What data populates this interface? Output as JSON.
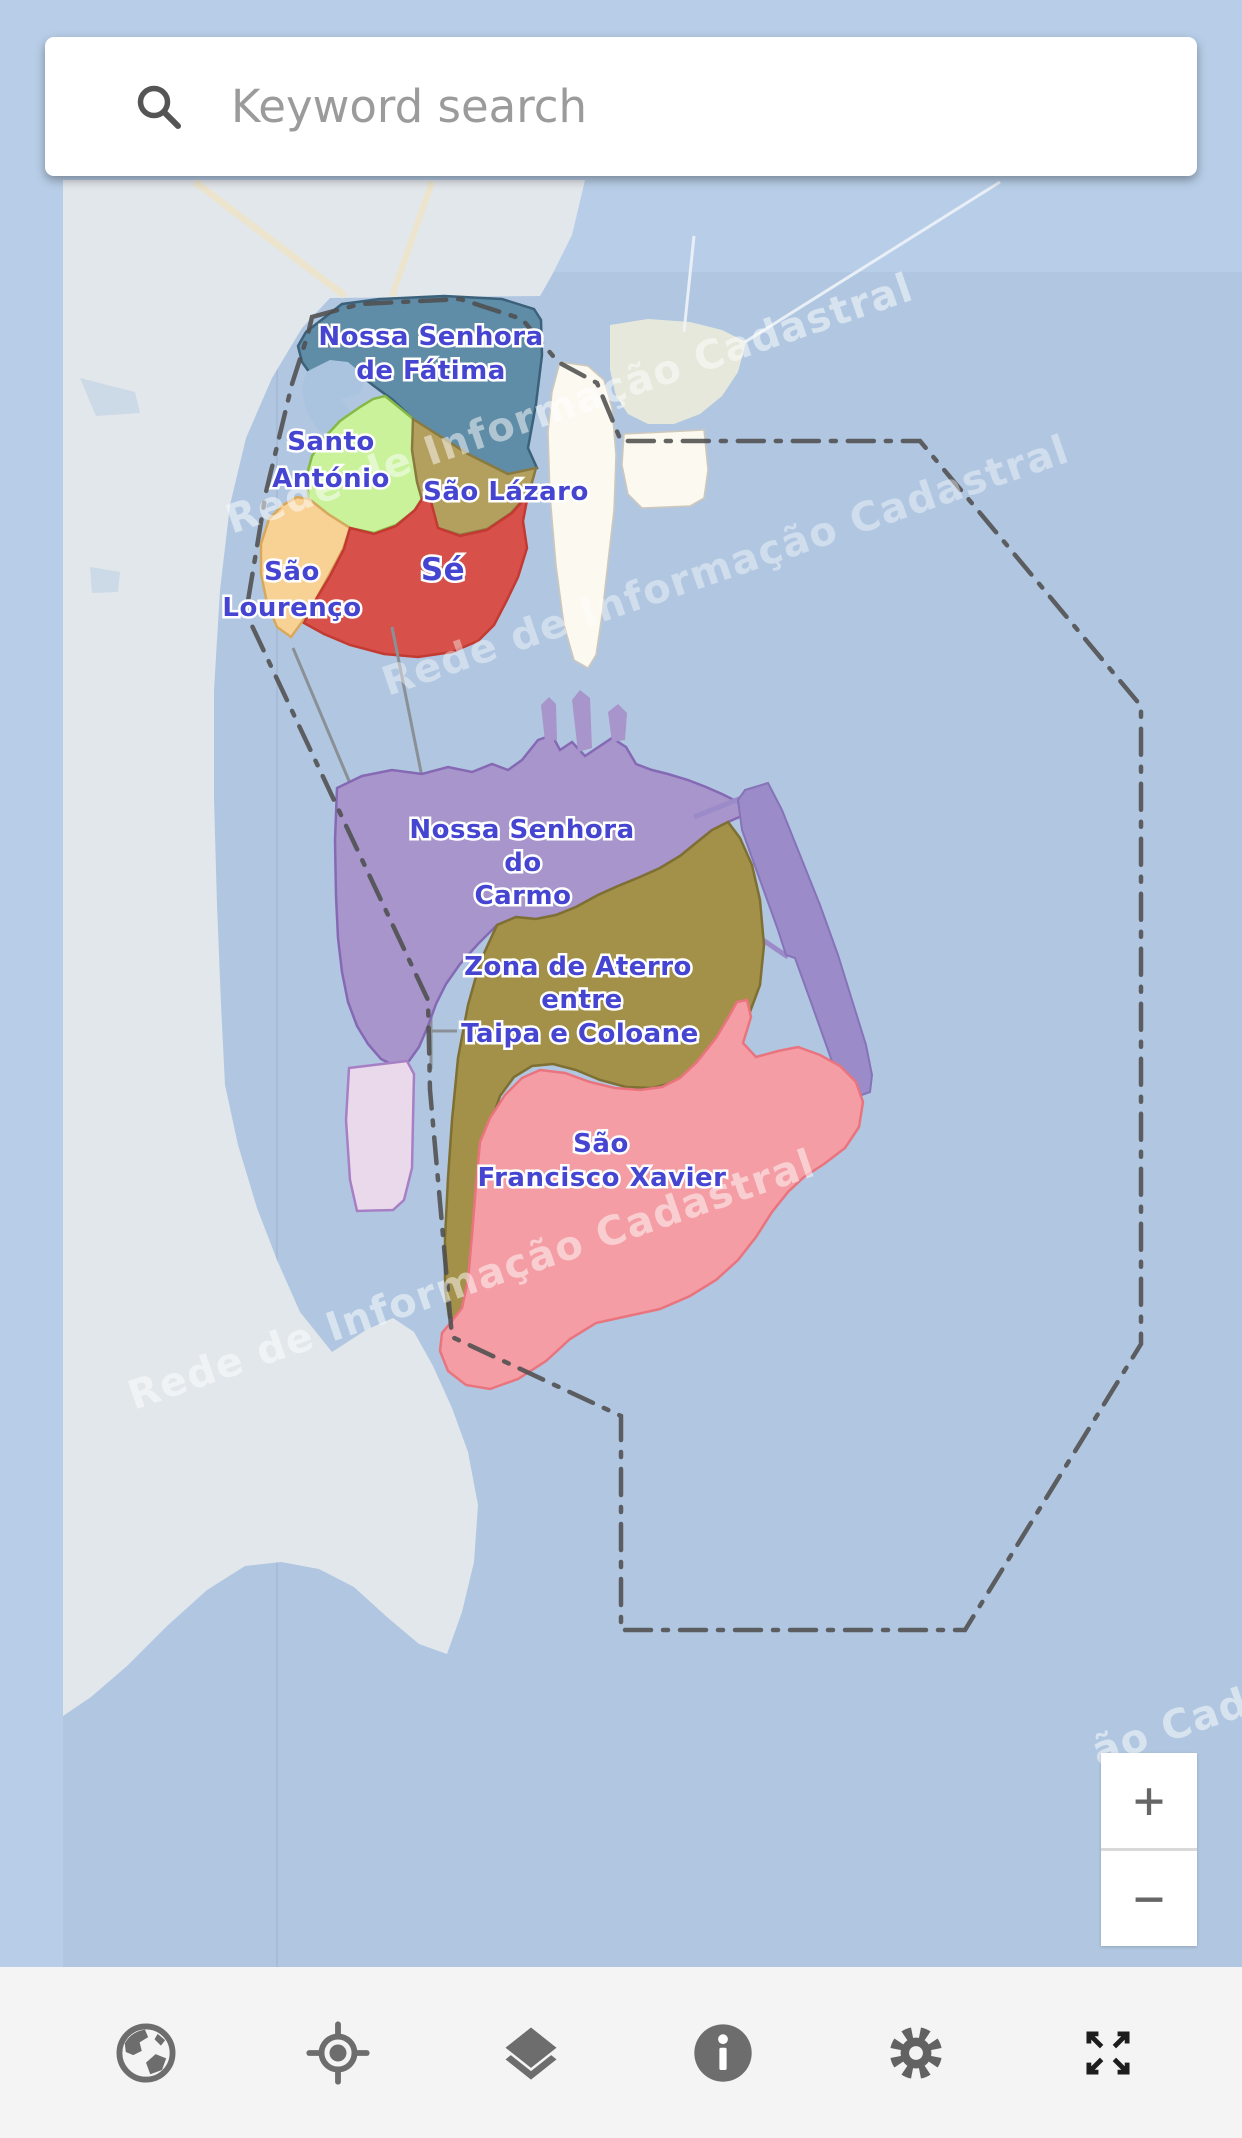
{
  "search": {
    "placeholder": "Keyword search",
    "icon": "search-icon"
  },
  "map": {
    "watermark": "Rede de Informação Cadastral",
    "watermark_fragment": "ão Cad",
    "colors": {
      "water": "#b1c7e1",
      "water_outside_tile": "#b8cee8",
      "mainland": "#e2e7eb",
      "reclaimed_white": "#fcf9f1",
      "reclaimed_pale": "#e6e8dc",
      "runway": "#9c8bc9",
      "university_parcel": "#ead9ea",
      "boundary_line": "#4f4f4f",
      "label_text": "#4545d2"
    },
    "regions": [
      {
        "id": "nossa-senhora-de-fatima",
        "label_lines": [
          "Nossa Senhora",
          "de Fátima"
        ],
        "color": "#5f8ca6"
      },
      {
        "id": "santo-antonio",
        "label_lines": [
          "Santo",
          "António"
        ],
        "color": "#c9f29b"
      },
      {
        "id": "sao-lazaro",
        "label_lines": [
          "São Lázaro"
        ],
        "color": "#b3a05e"
      },
      {
        "id": "sao-lourenco",
        "label_lines": [
          "São",
          "Lourenço"
        ],
        "color": "#f8d195"
      },
      {
        "id": "se",
        "label_lines": [
          "Sé"
        ],
        "color": "#d7514a"
      },
      {
        "id": "nossa-senhora-do-carmo",
        "label_lines": [
          "Nossa Senhora",
          "do",
          "Carmo"
        ],
        "color": "#a795cb"
      },
      {
        "id": "zona-de-aterro",
        "label_lines": [
          "Zona de Aterro",
          "entre",
          "Taipa e Coloane"
        ],
        "color": "#a39049"
      },
      {
        "id": "sao-francisco-xavier",
        "label_lines": [
          "São",
          "Francisco Xavier"
        ],
        "color": "#f49da4"
      }
    ],
    "zoom_controls": {
      "zoom_in": "+",
      "zoom_out": "−"
    }
  },
  "toolbar": {
    "buttons": [
      {
        "icon": "globe-icon"
      },
      {
        "icon": "locate-icon"
      },
      {
        "icon": "layers-icon"
      },
      {
        "icon": "info-icon"
      },
      {
        "icon": "settings-gear-icon"
      },
      {
        "icon": "fullscreen-icon"
      }
    ]
  }
}
